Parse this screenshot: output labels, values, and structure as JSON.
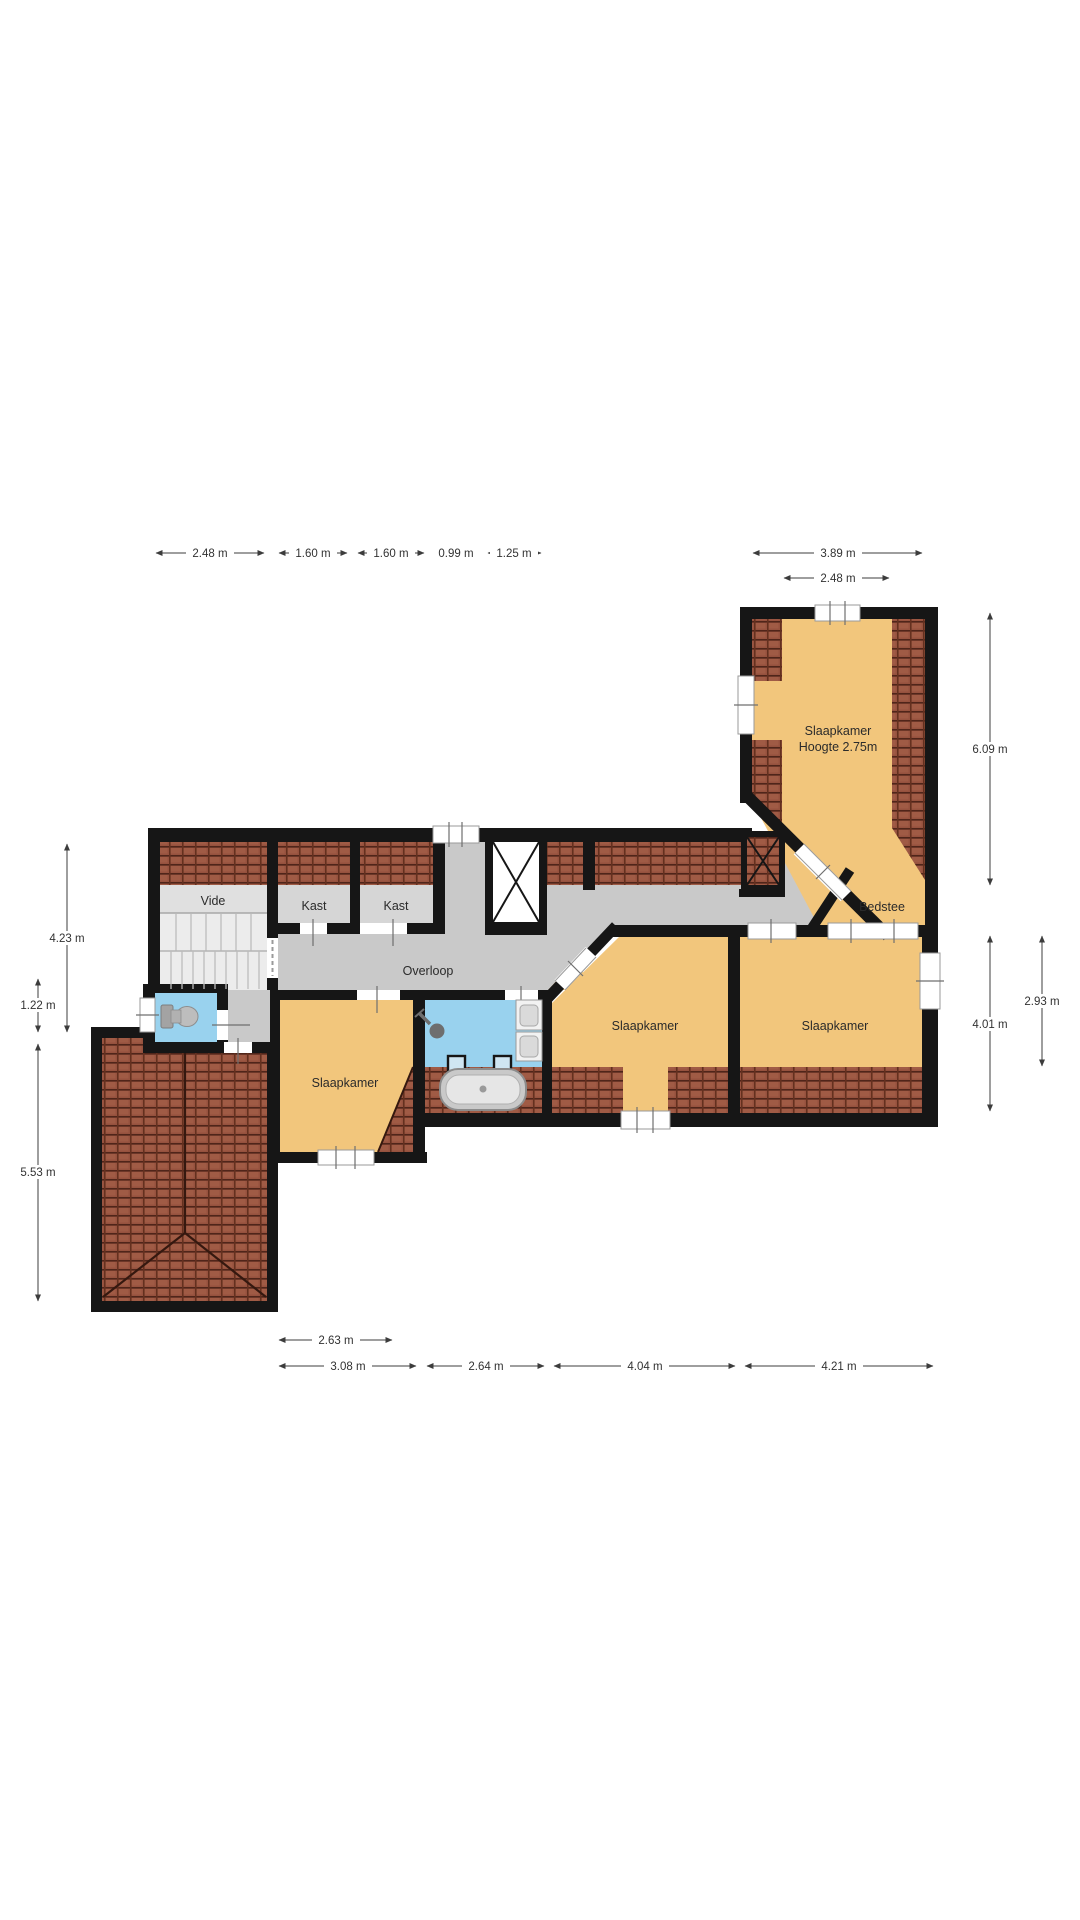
{
  "plan": {
    "rooms": [
      {
        "id": "slaapkamer-top",
        "label": "Slaapkamer",
        "sublabel": "Hoogte 2.75m"
      },
      {
        "id": "bedstee",
        "label": "Bedstee"
      },
      {
        "id": "vide",
        "label": "Vide"
      },
      {
        "id": "kast-1",
        "label": "Kast"
      },
      {
        "id": "kast-2",
        "label": "Kast"
      },
      {
        "id": "overloop",
        "label": "Overloop"
      },
      {
        "id": "slaapkamer-west",
        "label": "Slaapkamer"
      },
      {
        "id": "slaapkamer-mid",
        "label": "Slaapkamer"
      },
      {
        "id": "slaapkamer-east",
        "label": "Slaapkamer"
      }
    ],
    "fixtures": [
      {
        "icon": "toilet-icon"
      },
      {
        "icon": "shower-icon"
      },
      {
        "icon": "sink-icon"
      },
      {
        "icon": "sink-icon"
      },
      {
        "icon": "bathtub-icon"
      }
    ],
    "dimensions": {
      "top": [
        "2.48 m",
        "1.60 m",
        "1.60 m",
        "0.99 m",
        "1.25 m"
      ],
      "top_right": [
        "3.89 m",
        "2.48 m"
      ],
      "right": [
        "6.09 m",
        "4.01 m",
        "2.93 m"
      ],
      "left": [
        "4.23 m",
        "1.22 m",
        "5.53 m"
      ],
      "bottom_row1": [
        "2.63 m"
      ],
      "bottom_row2": [
        "3.08 m",
        "2.64 m",
        "4.04 m",
        "4.21 m"
      ]
    },
    "colors": {
      "wall": "#161616",
      "room": "#f2c67c",
      "corridor": "#c9c9c9",
      "closet": "#d6d6d6",
      "vide": "#e0e0e0",
      "stairs": "#ececec",
      "water": "#99d2ee",
      "dim": "#3c3c3c"
    }
  }
}
